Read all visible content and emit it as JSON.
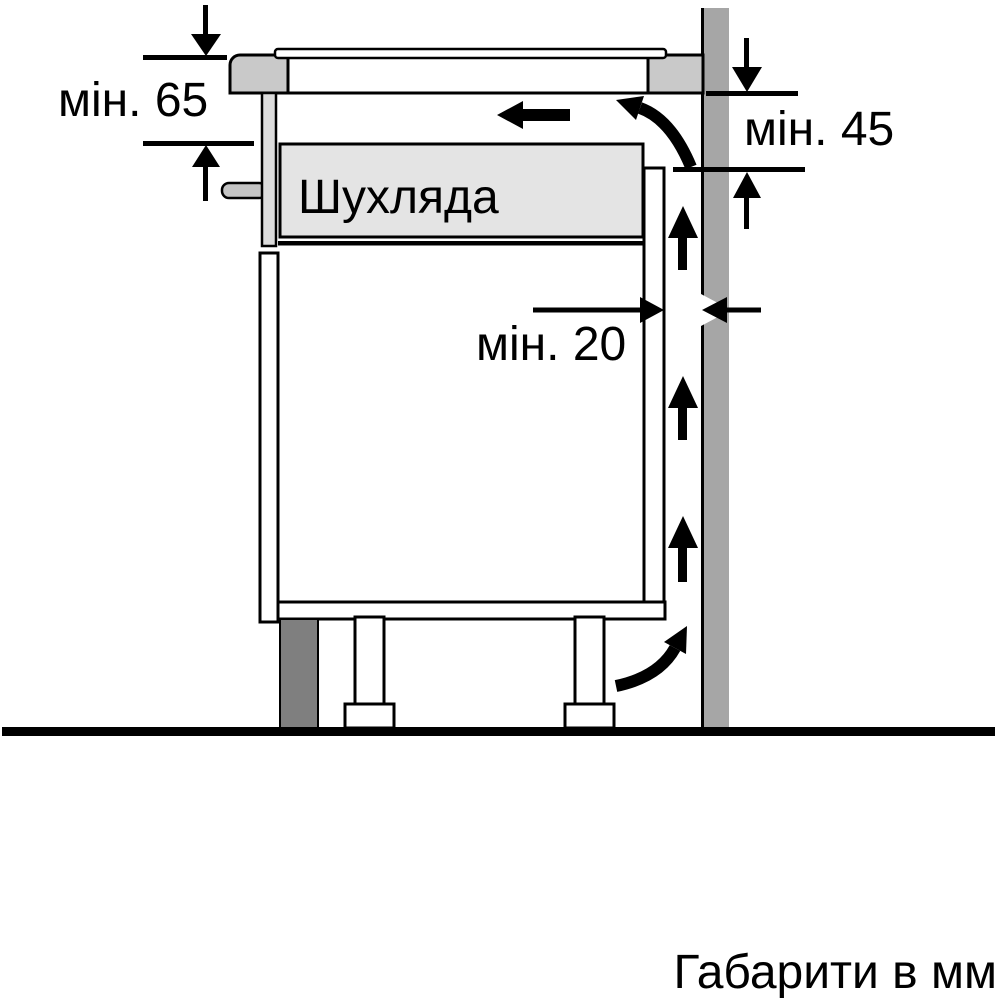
{
  "diagram": {
    "labels": {
      "clearance_below_worktop": "мін. 65",
      "clearance_behind_hob": "мін. 45",
      "gap_to_wall": "мін. 20",
      "drawer": "Шухляда",
      "caption": "Габарити в мм"
    },
    "values": {
      "clearance_below_worktop_mm": 65,
      "clearance_behind_hob_mm": 45,
      "gap_to_wall_mm": 20,
      "unit": "мм"
    },
    "colors": {
      "outline": "#000000",
      "background": "#ffffff",
      "wall": "#a6a6a6",
      "worktop": "#c9c9c9",
      "drawer_fill": "#e4e4e4",
      "front_trim": "#dcdcdc",
      "pin": "#c4c4c4",
      "plinth": "#7f7f7f"
    }
  }
}
